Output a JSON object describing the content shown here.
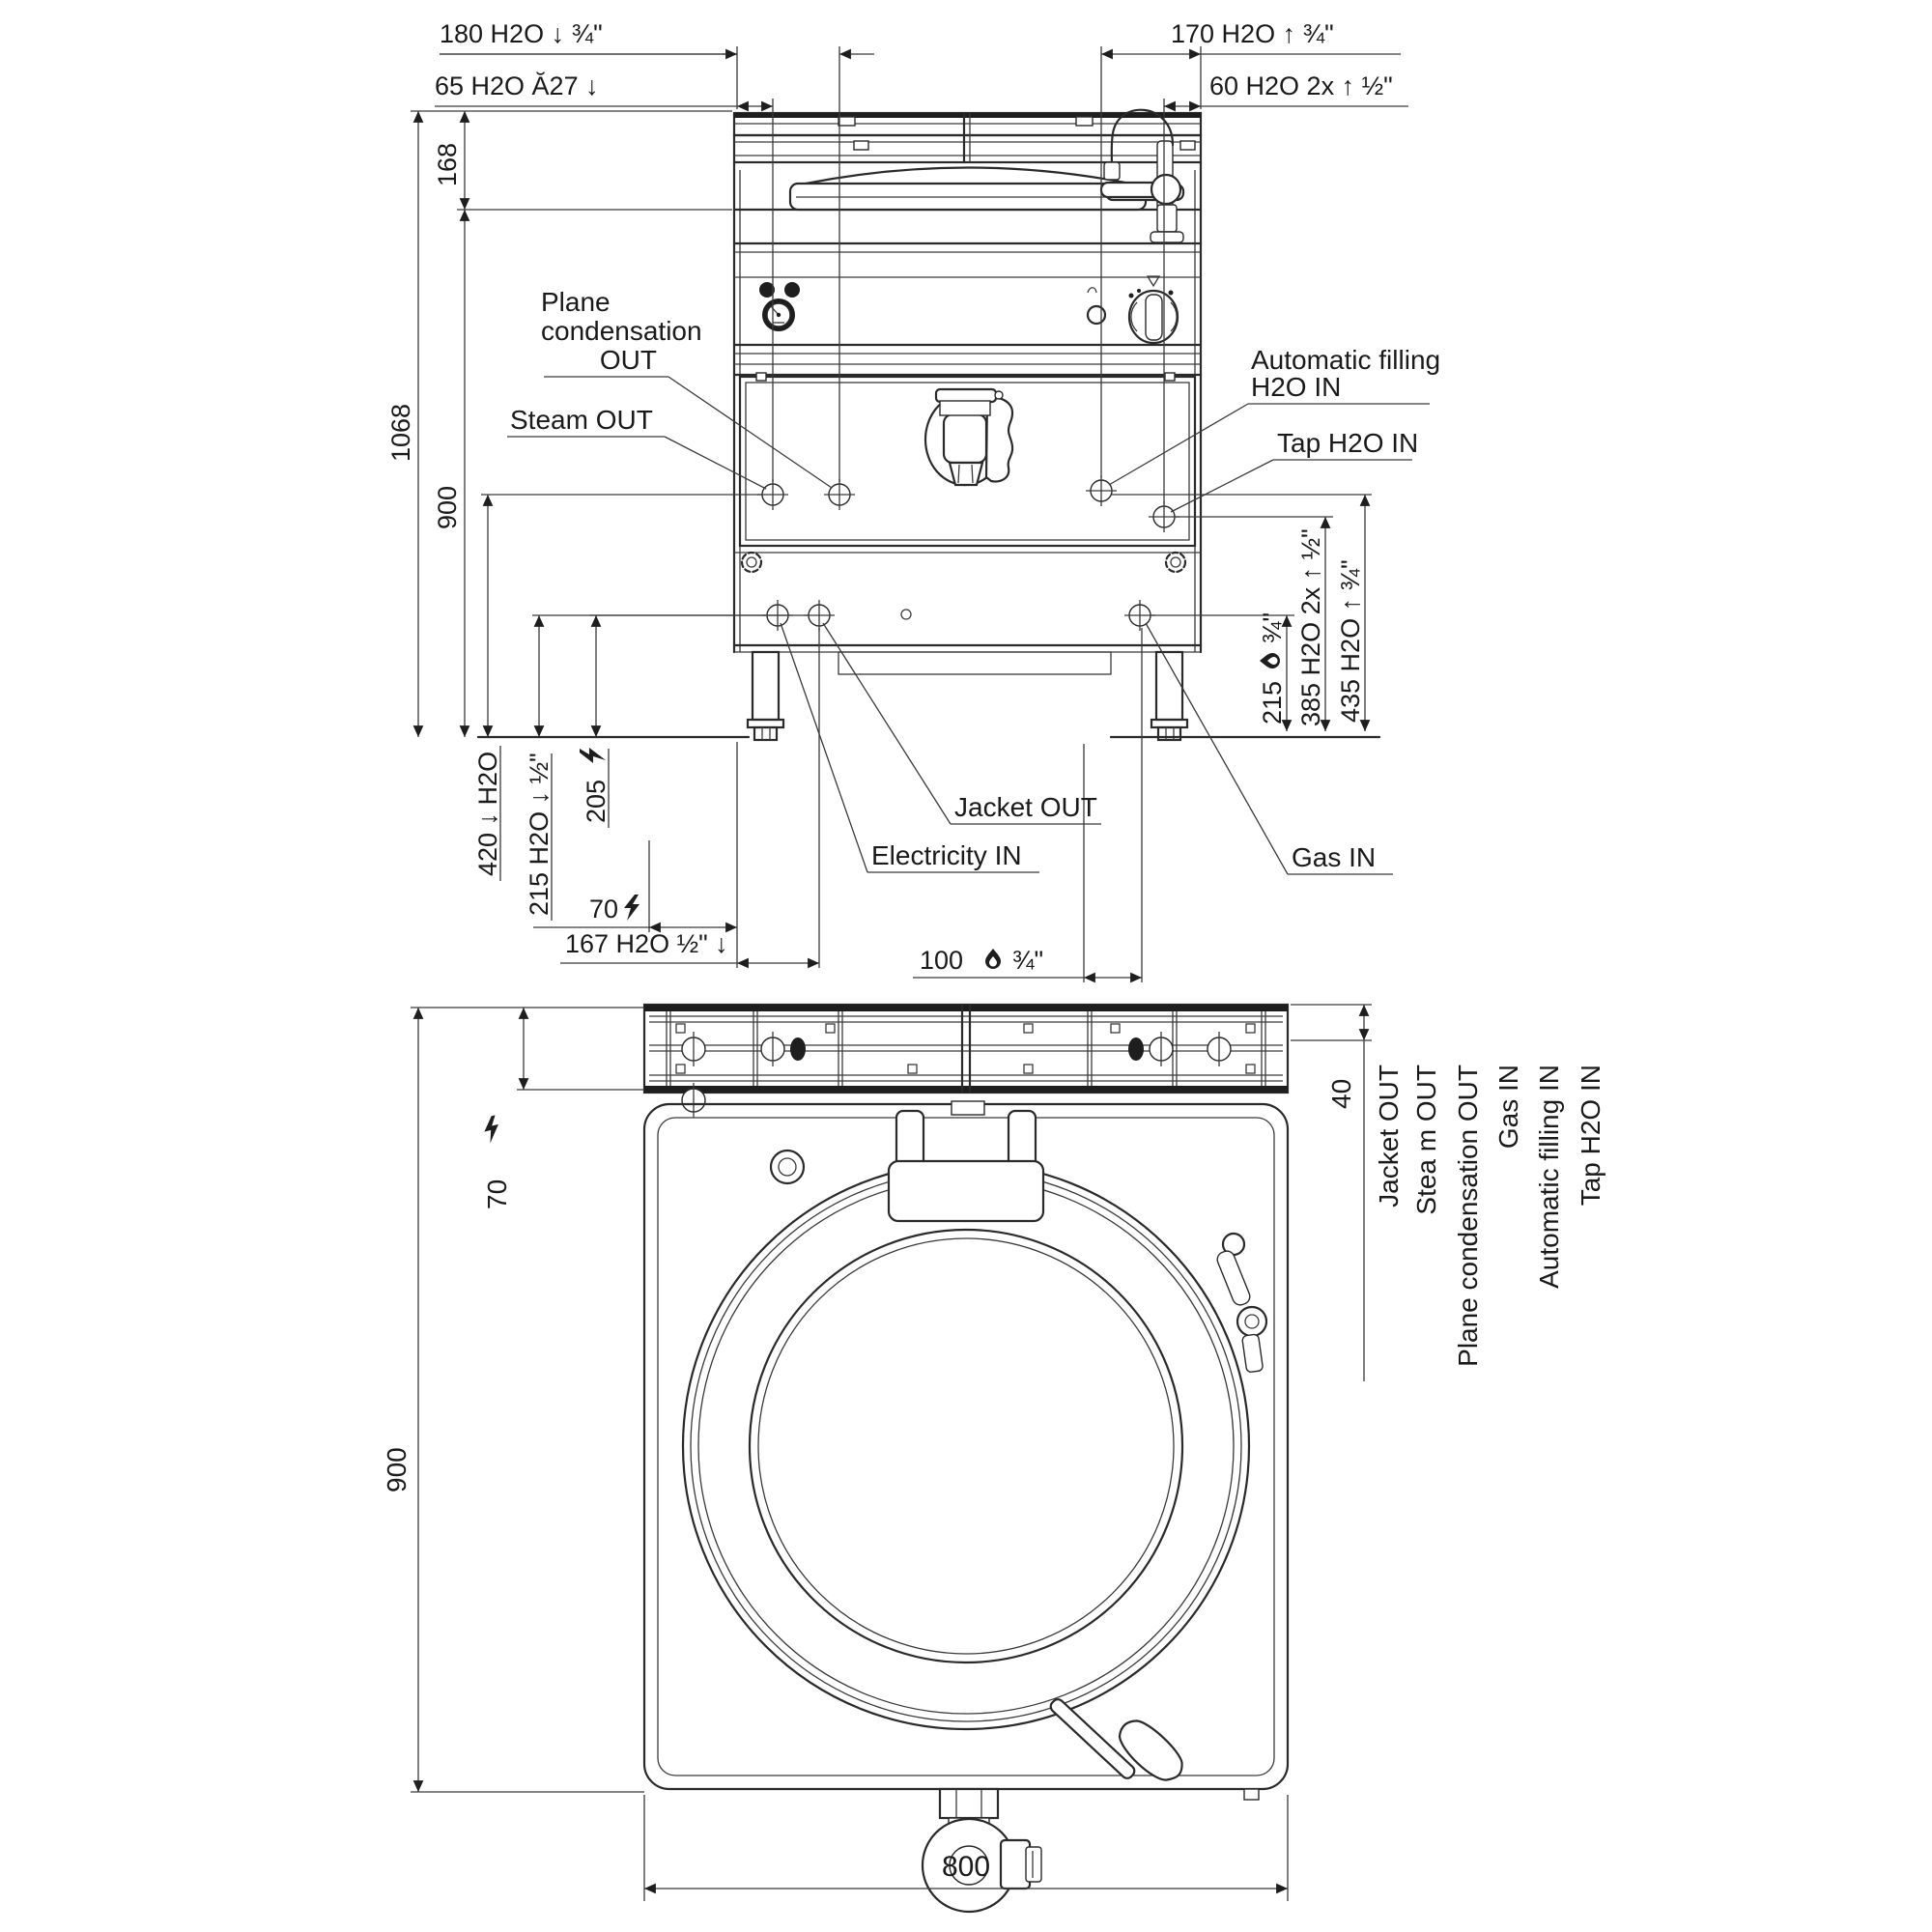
{
  "front_view": {
    "dims": {
      "d180": "180 H2O ↓ ¾\"",
      "d65": "65 H2O Ă27 ↓",
      "d170": "170 H2O ↑ ¾\"",
      "d60": "60 H2O 2x ↑ ½\"",
      "d1068": "1068",
      "d168": "168",
      "d900": "900",
      "d420": "420 ↓ H2O",
      "d215_water": "215 H2O ↓ ½\"",
      "d205": "205",
      "d70": "70",
      "d167": "167 H2O ½\" ↓",
      "d100": "100",
      "d100_suffix": "¾\"",
      "d215_gas": "215",
      "d215_gas_suffix": "¾\"",
      "d385": "385 H2O 2x ↑ ½\"",
      "d435": "435 H2O ↑ ¾\""
    },
    "callouts": {
      "plane_line1": "Plane",
      "plane_line2": "condensation",
      "plane_line3": "OUT",
      "steam": "Steam OUT",
      "autofill_line1": "Automatic filling",
      "autofill_line2": "H2O IN",
      "tap": "Tap H2O IN",
      "jacket": "Jacket OUT",
      "electricity": "Electricity IN",
      "gas": "Gas IN"
    }
  },
  "plan_view": {
    "dims": {
      "d900": "900",
      "d70": "70",
      "d40": "40",
      "d800": "800"
    },
    "port_labels": [
      "Jacket OUT",
      "Stea m OUT",
      "Plane condensation OUT",
      "Gas IN",
      "Automatic filling IN",
      "Tap H2O IN"
    ]
  }
}
